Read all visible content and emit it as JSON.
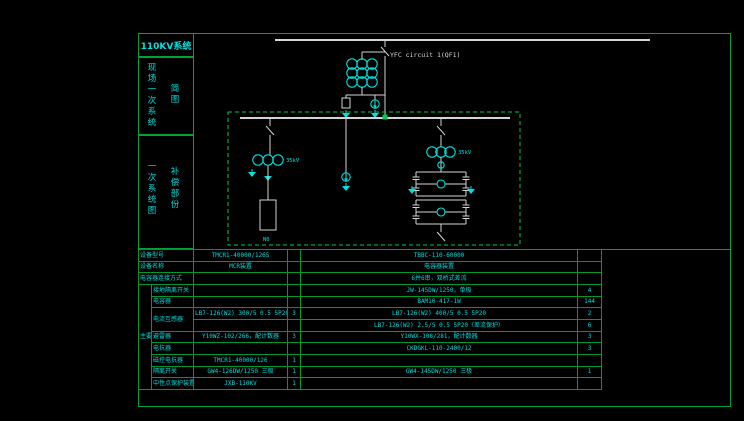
{
  "title": "110KV系统",
  "sidebar": {
    "section1": {
      "main": "现场一次系统",
      "sub": "简图"
    },
    "section2": {
      "main": "一次系统图",
      "sub": "补偿部份"
    }
  },
  "schematic": {
    "feeder_label": "YFC circuit 1(QF1)",
    "cluster_label_left": "35kV",
    "cluster_label_right": "35kV",
    "neutral_label": "N0",
    "colors": {
      "wire": "#d4d4d4",
      "symbol": "#00e0e0",
      "frame_green": "#00a23a",
      "dashed_green": "#00c84b",
      "text_cyan": "#00dcdc"
    }
  },
  "table": {
    "group_label": "主要元件",
    "rows": [
      {
        "label": "设备型号",
        "v1": "TMCR1-40000/126S",
        "q1": "",
        "v2": "TBBC-110-60000",
        "q2": ""
      },
      {
        "label": "设备名称",
        "v1": "MCR装置",
        "q1": "",
        "v2": "电容器装置",
        "q2": ""
      },
      {
        "label": "电容器连接方式",
        "v1": "",
        "q1": "",
        "v2": "6并6串，双桥式差流",
        "q2": ""
      },
      {
        "label": "接地隔离开关",
        "v1": "",
        "q1": "",
        "v2": "JW-145DW/1250，单极",
        "q2": "4"
      },
      {
        "label": "电容器",
        "v1": "",
        "q1": "",
        "v2": "BAM10-417-1W",
        "q2": "144"
      },
      {
        "label": "电流互感器",
        "v1": "LB7-126(W2) 300/5 0.5 5P20",
        "q1": "3",
        "v2": "LB7-126(W2) 400/5 0.5 5P20",
        "q2": "2"
      },
      {
        "v1": "",
        "q1": "",
        "v2": "LB7-126(W2) 2.5/5 0.5 5P20（差流保护）",
        "q2": "6"
      },
      {
        "label": "避雷器",
        "v1": "Y10WZ-102/266，配计数器",
        "q1": "3",
        "v2": "Y10WX-108/281，配计数器",
        "q2": "3"
      },
      {
        "label": "电抗器",
        "v1": "",
        "q1": "",
        "v2": "CKDGKL-110-2400/12",
        "q2": "3"
      },
      {
        "label": "磁控电抗器",
        "v1": "TMCR1-40000/126",
        "q1": "1",
        "v2": "",
        "q2": ""
      },
      {
        "label": "隔离开关",
        "v1": "GW4-126DW/1250 三极",
        "q1": "1",
        "v2": "GW4-145DW/1250 三极",
        "q2": "1"
      },
      {
        "label": "中性点保护装置",
        "v1": "JXB-110KV",
        "q1": "1",
        "v2": "",
        "q2": ""
      }
    ]
  }
}
